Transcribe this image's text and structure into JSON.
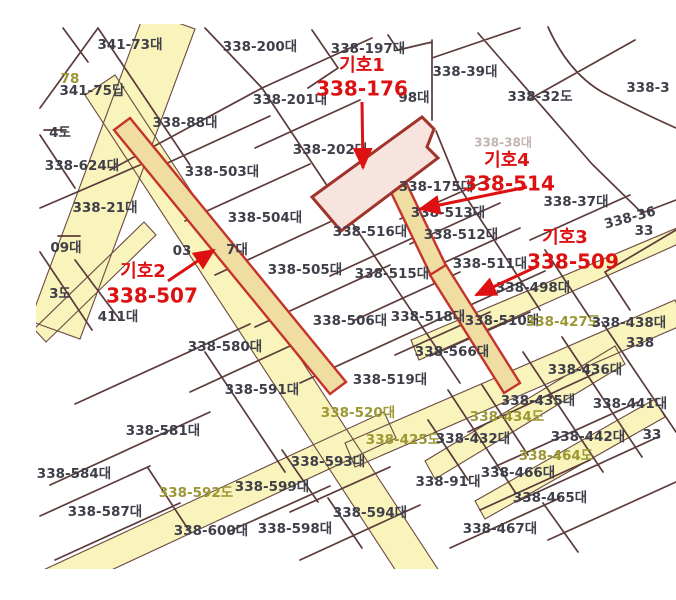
{
  "map_title": "cadastral-parcel-map",
  "colors": {
    "road_fill": "#f9f4bb",
    "road_edge": "#6b4a42",
    "strip_fill": "#efdda2",
    "strip_stroke": "#c5332a",
    "subject_fill": "#f7e4df",
    "subject_stroke": "#a0342a",
    "boundary_line": "#5c3b3b",
    "parcel_label": "#3f3f4a",
    "road_label": "#9c9733",
    "annotation_red": "#dd1111"
  },
  "parcel_labels": [
    {
      "t": "341-73대",
      "x": 130,
      "y": 45,
      "k": "p"
    },
    {
      "t": "338-200대",
      "x": 260,
      "y": 47,
      "k": "p"
    },
    {
      "t": "338-197대",
      "x": 368,
      "y": 49,
      "k": "p"
    },
    {
      "t": "338-39대",
      "x": 465,
      "y": 72,
      "k": "p"
    },
    {
      "t": "338-32도",
      "x": 540,
      "y": 97,
      "k": "p"
    },
    {
      "t": "338-3",
      "x": 648,
      "y": 88,
      "k": "p"
    },
    {
      "t": "78",
      "x": 70,
      "y": 79,
      "k": "r"
    },
    {
      "t": "341-75답",
      "x": 92,
      "y": 91,
      "k": "p"
    },
    {
      "t": "338-201대",
      "x": 290,
      "y": 100,
      "k": "p"
    },
    {
      "t": "98대",
      "x": 414,
      "y": 98,
      "k": "p"
    },
    {
      "t": "338-88대",
      "x": 185,
      "y": 123,
      "k": "p"
    },
    {
      "t": "4도",
      "x": 60,
      "y": 133,
      "k": "p"
    },
    {
      "t": "338-38대",
      "x": 503,
      "y": 143,
      "k": "f"
    },
    {
      "t": "338-202대",
      "x": 330,
      "y": 150,
      "k": "p"
    },
    {
      "t": "338-624대",
      "x": 82,
      "y": 166,
      "k": "p"
    },
    {
      "t": "338-503대",
      "x": 222,
      "y": 172,
      "k": "p"
    },
    {
      "t": "338-175대",
      "x": 436,
      "y": 187,
      "k": "p"
    },
    {
      "t": "338-37대",
      "x": 576,
      "y": 202,
      "k": "p"
    },
    {
      "t": "338-21대",
      "x": 105,
      "y": 208,
      "k": "p"
    },
    {
      "t": "338-513대",
      "x": 448,
      "y": 213,
      "k": "p"
    },
    {
      "t": "338-504대",
      "x": 265,
      "y": 218,
      "k": "p"
    },
    {
      "t": "338-36",
      "x": 630,
      "y": 218,
      "k": "p",
      "rot": -15
    },
    {
      "t": "33",
      "x": 644,
      "y": 231,
      "k": "p"
    },
    {
      "t": "338-516대",
      "x": 370,
      "y": 232,
      "k": "p"
    },
    {
      "t": "338-512대",
      "x": 461,
      "y": 235,
      "k": "p"
    },
    {
      "t": "09대",
      "x": 66,
      "y": 248,
      "k": "p"
    },
    {
      "t": "03",
      "x": 182,
      "y": 251,
      "k": "p"
    },
    {
      "t": "7대",
      "x": 237,
      "y": 250,
      "k": "p"
    },
    {
      "t": "338-511대",
      "x": 490,
      "y": 264,
      "k": "p"
    },
    {
      "t": "338-505대",
      "x": 305,
      "y": 270,
      "k": "p"
    },
    {
      "t": "338-515대",
      "x": 392,
      "y": 274,
      "k": "p"
    },
    {
      "t": "338-498대",
      "x": 533,
      "y": 288,
      "k": "p"
    },
    {
      "t": "3도",
      "x": 60,
      "y": 294,
      "k": "p"
    },
    {
      "t": "411대",
      "x": 118,
      "y": 317,
      "k": "p"
    },
    {
      "t": "338-518대",
      "x": 428,
      "y": 317,
      "k": "p"
    },
    {
      "t": "338-510대",
      "x": 502,
      "y": 321,
      "k": "p"
    },
    {
      "t": "338-427도",
      "x": 563,
      "y": 322,
      "k": "r"
    },
    {
      "t": "338-438대",
      "x": 629,
      "y": 323,
      "k": "p"
    },
    {
      "t": "338-506대",
      "x": 350,
      "y": 321,
      "k": "p"
    },
    {
      "t": "338",
      "x": 640,
      "y": 343,
      "k": "p"
    },
    {
      "t": "338-566대",
      "x": 452,
      "y": 352,
      "k": "p"
    },
    {
      "t": "338-580대",
      "x": 225,
      "y": 347,
      "k": "p"
    },
    {
      "t": "338-436대",
      "x": 585,
      "y": 370,
      "k": "p"
    },
    {
      "t": "338-591대",
      "x": 262,
      "y": 390,
      "k": "p"
    },
    {
      "t": "338-519대",
      "x": 390,
      "y": 380,
      "k": "p"
    },
    {
      "t": "338-435대",
      "x": 538,
      "y": 401,
      "k": "p"
    },
    {
      "t": "338-441대",
      "x": 630,
      "y": 404,
      "k": "p"
    },
    {
      "t": "338-520대",
      "x": 358,
      "y": 413,
      "k": "r"
    },
    {
      "t": "338-434도",
      "x": 507,
      "y": 417,
      "k": "r"
    },
    {
      "t": "338-581대",
      "x": 163,
      "y": 431,
      "k": "p"
    },
    {
      "t": "338-442대",
      "x": 588,
      "y": 437,
      "k": "p"
    },
    {
      "t": "33",
      "x": 652,
      "y": 435,
      "k": "p"
    },
    {
      "t": "338-425도",
      "x": 403,
      "y": 440,
      "k": "r"
    },
    {
      "t": "338-432대",
      "x": 473,
      "y": 439,
      "k": "p"
    },
    {
      "t": "338-464도",
      "x": 556,
      "y": 456,
      "k": "r"
    },
    {
      "t": "338-593대",
      "x": 328,
      "y": 462,
      "k": "p"
    },
    {
      "t": "338-91대",
      "x": 448,
      "y": 482,
      "k": "p"
    },
    {
      "t": "338-466대",
      "x": 518,
      "y": 473,
      "k": "p"
    },
    {
      "t": "338-584대",
      "x": 74,
      "y": 474,
      "k": "p"
    },
    {
      "t": "338-599대",
      "x": 272,
      "y": 487,
      "k": "p"
    },
    {
      "t": "338-592도",
      "x": 196,
      "y": 493,
      "k": "r"
    },
    {
      "t": "338-465대",
      "x": 550,
      "y": 498,
      "k": "p"
    },
    {
      "t": "338-587대",
      "x": 105,
      "y": 512,
      "k": "p"
    },
    {
      "t": "338-594대",
      "x": 370,
      "y": 513,
      "k": "p"
    },
    {
      "t": "338-467대",
      "x": 500,
      "y": 529,
      "k": "p"
    },
    {
      "t": "338-600대",
      "x": 211,
      "y": 531,
      "k": "p"
    },
    {
      "t": "338-598대",
      "x": 295,
      "y": 529,
      "k": "p"
    }
  ],
  "annotations": [
    {
      "symbol": "기호1",
      "number": "338-176",
      "sx": 362,
      "sy": 66,
      "nx": 362,
      "ny": 90,
      "ax1": 362,
      "ay1": 102,
      "ax2": 363,
      "ay2": 168
    },
    {
      "symbol": "기호2",
      "number": "338-507",
      "sx": 143,
      "sy": 272,
      "nx": 152,
      "ny": 297,
      "ax1": 168,
      "ay1": 281,
      "ax2": 214,
      "ay2": 250
    },
    {
      "symbol": "기호3",
      "number": "338-509",
      "sx": 565,
      "sy": 238,
      "nx": 573,
      "ny": 263,
      "ax1": 538,
      "ay1": 266,
      "ax2": 476,
      "ay2": 295
    },
    {
      "symbol": "기호4",
      "number": "338-514",
      "sx": 507,
      "sy": 161,
      "nx": 509,
      "ny": 185,
      "ax1": 527,
      "ay1": 187,
      "ax2": 420,
      "ay2": 209
    }
  ]
}
